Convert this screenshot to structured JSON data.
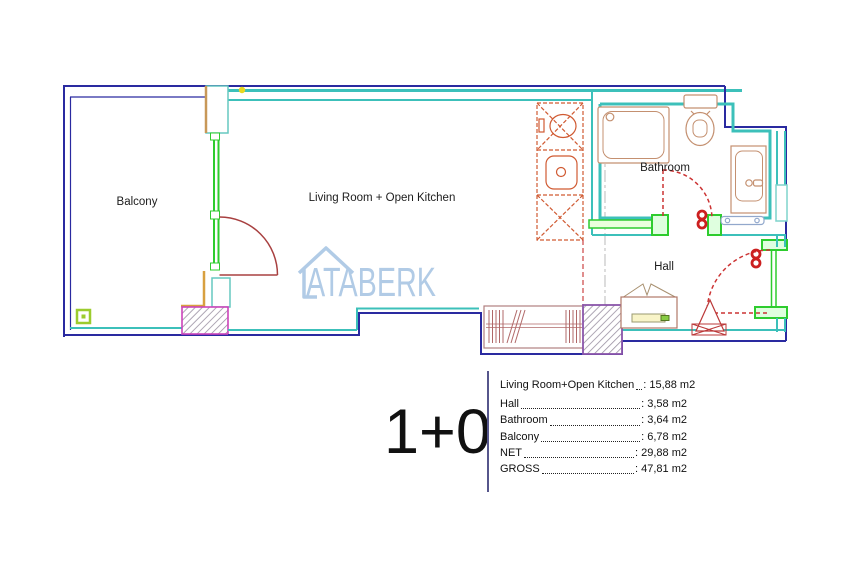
{
  "floor_plan": {
    "room_labels": {
      "balcony": "Balcony",
      "living_room": "Living Room + Open Kitchen",
      "bathroom": "Bathroom",
      "hall": "Hall"
    },
    "watermark_text": "ATABERK",
    "unit_type_label": "1+0",
    "area_table": {
      "rows": [
        {
          "label": "Living Room+Open Kitchen",
          "value": ": 15,88 m2"
        },
        {
          "label": "Hall",
          "value": ": 3,58 m2"
        },
        {
          "label": "Bathroom",
          "value": ": 3,64 m2"
        },
        {
          "label": "Balcony",
          "value": ": 6,78 m2"
        },
        {
          "label": "NET",
          "value": ": 29,88 m2"
        },
        {
          "label": "GROSS",
          "value": ": 47,81 m2"
        }
      ]
    },
    "colors": {
      "outer_wall_navy": "#2a2aa0",
      "inner_wall_teal": "#3cc0ba",
      "frame_green": "#2ecc2e",
      "door_red": "#bb3333",
      "kitchen_orange": "#d05a32",
      "fixture_tan": "#c49070",
      "watermark_blue": "#a9c6e4",
      "column_hatch_magenta": "#cc44bb",
      "column_hatch_purple": "#8a55aa"
    }
  }
}
